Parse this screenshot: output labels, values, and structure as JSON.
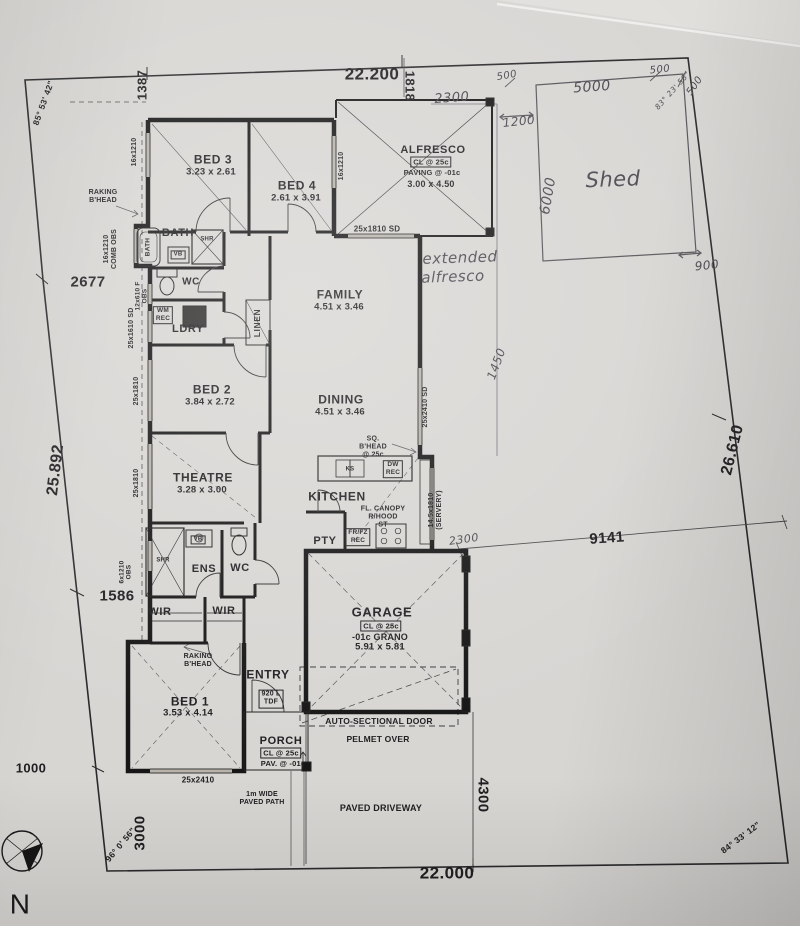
{
  "plan": {
    "labels": [
      {
        "n": "dim-1387",
        "t": "1387",
        "x": 143,
        "y": 85,
        "fs": 13,
        "r": -90,
        "cls": "dim"
      },
      {
        "n": "dim-22-200",
        "t": "22.200",
        "x": 372,
        "y": 74,
        "fs": 17,
        "cls": "dim"
      },
      {
        "n": "dim-1818",
        "t": "1818",
        "x": 409,
        "y": 86,
        "fs": 13,
        "r": 90,
        "cls": "dim"
      },
      {
        "n": "angle-nw",
        "t": "85° 53' 42\"",
        "x": 44,
        "y": 103,
        "fs": 8.5,
        "r": -70,
        "cls": "dim"
      },
      {
        "n": "dim-2677",
        "t": "2677",
        "x": 88,
        "y": 283,
        "fs": 15,
        "cls": "dim"
      },
      {
        "n": "dim-25-892",
        "t": "25.892",
        "x": 56,
        "y": 470,
        "fs": 16,
        "r": -83,
        "cls": "dim"
      },
      {
        "n": "dim-1586",
        "t": "1586",
        "x": 117,
        "y": 597,
        "fs": 15,
        "cls": "dim"
      },
      {
        "n": "dim-1000",
        "t": "1000",
        "x": 31,
        "y": 769,
        "fs": 13,
        "cls": "dim"
      },
      {
        "n": "dim-3000",
        "t": "3000",
        "x": 141,
        "y": 833,
        "fs": 15,
        "r": -90,
        "cls": "dim"
      },
      {
        "n": "angle-sw",
        "t": "96° 0' 56\"",
        "x": 121,
        "y": 845,
        "fs": 8.5,
        "r": -50,
        "cls": "dim"
      },
      {
        "n": "dim-22-000",
        "t": "22.000",
        "x": 447,
        "y": 873,
        "fs": 17,
        "cls": "dim"
      },
      {
        "n": "dim-4300",
        "t": "4300",
        "x": 482,
        "y": 795,
        "fs": 15,
        "r": 90,
        "cls": "dim"
      },
      {
        "n": "dim-9141",
        "t": "9141",
        "x": 607,
        "y": 539,
        "fs": 15,
        "r": -4,
        "cls": "dim"
      },
      {
        "n": "dim-26-610",
        "t": "26.610",
        "x": 733,
        "y": 450,
        "fs": 16,
        "r": -76,
        "cls": "dim"
      },
      {
        "n": "angle-se",
        "t": "84° 33' 12\"",
        "x": 741,
        "y": 838,
        "fs": 8.5,
        "r": -37,
        "cls": "dim"
      },
      {
        "n": "hand-2300-top",
        "t": "2300",
        "x": 452,
        "y": 99,
        "fs": 13,
        "r": -4,
        "cls": "hand"
      },
      {
        "n": "hand-1200",
        "t": "1200",
        "x": 519,
        "y": 122,
        "fs": 12,
        "r": -6,
        "cls": "hand"
      },
      {
        "n": "hand-500-left",
        "t": "500",
        "x": 507,
        "y": 76,
        "fs": 10,
        "r": -10,
        "cls": "hand"
      },
      {
        "n": "hand-5000",
        "t": "5000",
        "x": 592,
        "y": 88,
        "fs": 14,
        "r": -4,
        "cls": "hand"
      },
      {
        "n": "hand-500-right",
        "t": "500",
        "x": 660,
        "y": 70,
        "fs": 10,
        "r": -6,
        "cls": "hand"
      },
      {
        "n": "hand-angle-ne",
        "t": "83° 23' 58\"",
        "x": 673,
        "y": 91,
        "fs": 7.5,
        "r": -48,
        "cls": "hand"
      },
      {
        "n": "hand-500-corner",
        "t": "500",
        "x": 695,
        "y": 86,
        "fs": 10,
        "r": -55,
        "cls": "hand"
      },
      {
        "n": "hand-6000",
        "t": "6000",
        "x": 549,
        "y": 196,
        "fs": 14,
        "r": -80,
        "cls": "hand"
      },
      {
        "n": "hand-shed",
        "t": "Shed",
        "x": 613,
        "y": 180,
        "fs": 21,
        "r": -2,
        "cls": "hand"
      },
      {
        "n": "hand-900",
        "t": "900",
        "x": 707,
        "y": 266,
        "fs": 12,
        "r": -6,
        "cls": "hand"
      },
      {
        "n": "hand-extended",
        "t": "extended",
        "x": 460,
        "y": 258,
        "fs": 15,
        "r": -2,
        "cls": "hand"
      },
      {
        "n": "hand-alfresco",
        "t": "alfresco",
        "x": 453,
        "y": 277,
        "fs": 15,
        "r": -2,
        "cls": "hand"
      },
      {
        "n": "hand-1450",
        "t": "1450",
        "x": 497,
        "y": 364,
        "fs": 12,
        "r": -70,
        "cls": "hand"
      },
      {
        "n": "hand-2300-bottom",
        "t": "2300",
        "x": 464,
        "y": 540,
        "fs": 11,
        "r": -8,
        "cls": "hand"
      },
      {
        "n": "room-bed3",
        "t": "BED 3",
        "x": 213,
        "y": 160,
        "fs": 12,
        "cls": "room"
      },
      {
        "n": "size-bed3",
        "t": "3.23 x 2.61",
        "x": 211,
        "y": 173,
        "fs": 9.5
      },
      {
        "n": "win-bed3",
        "t": "16x1210",
        "x": 135,
        "y": 152,
        "fs": 7,
        "r": -90
      },
      {
        "n": "note-raking-1",
        "t": "RAKING\nB'HEAD",
        "x": 103,
        "y": 197,
        "fs": 7
      },
      {
        "n": "win-comb-obs",
        "t": "16x1210\nCOMB OBS",
        "x": 111,
        "y": 249,
        "fs": 7,
        "r": -90
      },
      {
        "n": "room-bed4",
        "t": "BED 4",
        "x": 297,
        "y": 186,
        "fs": 12,
        "cls": "room"
      },
      {
        "n": "size-bed4",
        "t": "2.61 x 3.91",
        "x": 296,
        "y": 199,
        "fs": 9.5
      },
      {
        "n": "win-bed4",
        "t": "16x1210",
        "x": 342,
        "y": 166,
        "fs": 7,
        "r": -90
      },
      {
        "n": "room-alfresco",
        "t": "ALFRESCO",
        "x": 433,
        "y": 150,
        "fs": 11,
        "cls": "room"
      },
      {
        "n": "note-alfresco-cl",
        "t": "CL @ 25c",
        "x": 431,
        "y": 162,
        "fs": 7.5,
        "cls": "boxed"
      },
      {
        "n": "note-alfresco-paving",
        "t": "PAVING @ -01c",
        "x": 432,
        "y": 173,
        "fs": 7.5
      },
      {
        "n": "size-alfresco",
        "t": "3.00 x 4.50",
        "x": 431,
        "y": 184,
        "fs": 9
      },
      {
        "n": "win-family-sd",
        "t": "25x1810 SD",
        "x": 377,
        "y": 230,
        "fs": 8
      },
      {
        "n": "room-bath",
        "t": "BATH",
        "x": 178,
        "y": 233,
        "fs": 11,
        "cls": "room"
      },
      {
        "n": "fixture-bath-label",
        "t": "BATH",
        "x": 148,
        "y": 247,
        "fs": 6.5,
        "r": -90
      },
      {
        "n": "fixture-shr-1",
        "t": "SHR",
        "x": 207,
        "y": 240,
        "fs": 6
      },
      {
        "n": "fixture-vb-1",
        "t": "VB",
        "x": 178,
        "y": 255,
        "fs": 6,
        "cls": "boxed"
      },
      {
        "n": "room-wc-1",
        "t": "WC",
        "x": 191,
        "y": 282,
        "fs": 10,
        "cls": "room"
      },
      {
        "n": "win-f-obs",
        "t": "12x610 F\nOBS",
        "x": 142,
        "y": 296,
        "fs": 6.5,
        "r": -90
      },
      {
        "n": "fixture-wm-rec",
        "t": "WM\nREC",
        "x": 163,
        "y": 315,
        "fs": 6.5,
        "cls": "boxed"
      },
      {
        "n": "room-ldry",
        "t": "LDRY",
        "x": 188,
        "y": 329,
        "fs": 11,
        "cls": "room"
      },
      {
        "n": "win-ldry",
        "t": "25x1610 SD",
        "x": 132,
        "y": 328,
        "fs": 7,
        "r": -90
      },
      {
        "n": "room-linen",
        "t": "LINEN",
        "x": 258,
        "y": 323,
        "fs": 8.5,
        "r": -90,
        "cls": "room"
      },
      {
        "n": "room-family",
        "t": "FAMILY",
        "x": 340,
        "y": 295,
        "fs": 12,
        "cls": "room"
      },
      {
        "n": "size-family",
        "t": "4.51 x 3.46",
        "x": 339,
        "y": 308,
        "fs": 9.5
      },
      {
        "n": "room-bed2",
        "t": "BED 2",
        "x": 212,
        "y": 390,
        "fs": 12,
        "cls": "room"
      },
      {
        "n": "size-bed2",
        "t": "3.84 x 2.72",
        "x": 210,
        "y": 403,
        "fs": 9.5
      },
      {
        "n": "win-bed2",
        "t": "25x1810",
        "x": 137,
        "y": 391,
        "fs": 7,
        "r": -90
      },
      {
        "n": "room-dining",
        "t": "DINING",
        "x": 341,
        "y": 400,
        "fs": 12,
        "cls": "room"
      },
      {
        "n": "size-dining",
        "t": "4.51 x 3.46",
        "x": 340,
        "y": 413,
        "fs": 9.5
      },
      {
        "n": "win-dining-sd",
        "t": "25x2410 SD",
        "x": 426,
        "y": 407,
        "fs": 7,
        "r": -90
      },
      {
        "n": "room-theatre",
        "t": "THEATRE",
        "x": 203,
        "y": 478,
        "fs": 12,
        "cls": "room"
      },
      {
        "n": "size-theatre",
        "t": "3.28 x 3.00",
        "x": 202,
        "y": 491,
        "fs": 9.5
      },
      {
        "n": "win-theatre",
        "t": "25x1810",
        "x": 137,
        "y": 483,
        "fs": 7,
        "r": -90
      },
      {
        "n": "note-sq-bhead",
        "t": "SQ.\nB'HEAD\n@ 25c",
        "x": 373,
        "y": 447,
        "fs": 7
      },
      {
        "n": "fixture-ks",
        "t": "KS",
        "x": 350,
        "y": 470,
        "fs": 6
      },
      {
        "n": "fixture-dw-rec",
        "t": "DW\nREC",
        "x": 393,
        "y": 469,
        "fs": 6.5,
        "cls": "boxed"
      },
      {
        "n": "room-kitchen",
        "t": "KITCHEN",
        "x": 337,
        "y": 497,
        "fs": 12,
        "cls": "room"
      },
      {
        "n": "note-canopy",
        "t": "FL. CANOPY\nR/HOOD\nST",
        "x": 383,
        "y": 517,
        "fs": 7
      },
      {
        "n": "room-pty",
        "t": "PTY",
        "x": 325,
        "y": 541,
        "fs": 11,
        "cls": "room"
      },
      {
        "n": "fixture-frfz",
        "t": "FR/FZ\nREC",
        "x": 358,
        "y": 537,
        "fs": 6.5,
        "cls": "boxed"
      },
      {
        "n": "win-servery",
        "t": "14.5x1810\n(SERVERY)",
        "x": 436,
        "y": 510,
        "fs": 7,
        "r": -90
      },
      {
        "n": "room-garage",
        "t": "GARAGE",
        "x": 382,
        "y": 613,
        "fs": 13,
        "cls": "room"
      },
      {
        "n": "note-garage-cl",
        "t": "CL @ 25c",
        "x": 381,
        "y": 626,
        "fs": 7.5,
        "cls": "boxed"
      },
      {
        "n": "note-garage-grano",
        "t": "-01c GRANO",
        "x": 380,
        "y": 637,
        "fs": 9
      },
      {
        "n": "size-garage",
        "t": "5.91 x 5.81",
        "x": 380,
        "y": 648,
        "fs": 9.5
      },
      {
        "n": "note-auto-door",
        "t": "AUTO-SECTIONAL DOOR",
        "x": 379,
        "y": 722,
        "fs": 8.5
      },
      {
        "n": "note-pelmet",
        "t": "PELMET OVER",
        "x": 378,
        "y": 740,
        "fs": 8.5
      },
      {
        "n": "room-ens",
        "t": "ENS",
        "x": 204,
        "y": 569,
        "fs": 11,
        "cls": "room"
      },
      {
        "n": "room-wc-2",
        "t": "WC",
        "x": 240,
        "y": 568,
        "fs": 11,
        "cls": "room"
      },
      {
        "n": "fixture-shr-2",
        "t": "SHR",
        "x": 163,
        "y": 561,
        "fs": 6
      },
      {
        "n": "fixture-vb-2",
        "t": "VB",
        "x": 198,
        "y": 540,
        "fs": 6,
        "cls": "boxed"
      },
      {
        "n": "win-ens-obs",
        "t": "6x1210\nOBS",
        "x": 126,
        "y": 572,
        "fs": 6.5,
        "r": -90
      },
      {
        "n": "room-wir-1",
        "t": "WIR",
        "x": 160,
        "y": 612,
        "fs": 11,
        "cls": "room"
      },
      {
        "n": "room-wir-2",
        "t": "WIR",
        "x": 224,
        "y": 611,
        "fs": 11,
        "cls": "room"
      },
      {
        "n": "note-raking-2",
        "t": "RAKING\nB'HEAD",
        "x": 198,
        "y": 661,
        "fs": 7
      },
      {
        "n": "room-entry",
        "t": "ENTRY",
        "x": 268,
        "y": 675,
        "fs": 12,
        "cls": "room"
      },
      {
        "n": "fixture-tdf",
        "t": "920 L\nTDF",
        "x": 271,
        "y": 699,
        "fs": 7,
        "cls": "boxed"
      },
      {
        "n": "room-bed1",
        "t": "BED 1",
        "x": 190,
        "y": 702,
        "fs": 12,
        "cls": "room"
      },
      {
        "n": "size-bed1",
        "t": "3.53 x 4.14",
        "x": 188,
        "y": 714,
        "fs": 9.5
      },
      {
        "n": "room-porch",
        "t": "PORCH",
        "x": 281,
        "y": 741,
        "fs": 11,
        "cls": "room"
      },
      {
        "n": "note-porch-cl",
        "t": "CL @ 25c",
        "x": 281,
        "y": 753,
        "fs": 7.5,
        "cls": "boxed"
      },
      {
        "n": "note-porch-pav",
        "t": "PAV. @ -01c",
        "x": 283,
        "y": 764,
        "fs": 7.5
      },
      {
        "n": "win-bed1",
        "t": "25x2410",
        "x": 198,
        "y": 781,
        "fs": 8
      },
      {
        "n": "note-paved-path",
        "t": "1m WIDE\nPAVED PATH",
        "x": 262,
        "y": 799,
        "fs": 7
      },
      {
        "n": "note-driveway",
        "t": "PAVED DRIVEWAY",
        "x": 381,
        "y": 808,
        "fs": 9
      },
      {
        "n": "compass-n",
        "t": "N",
        "x": 20,
        "y": 904,
        "fs": 28,
        "cls": "north"
      }
    ]
  }
}
